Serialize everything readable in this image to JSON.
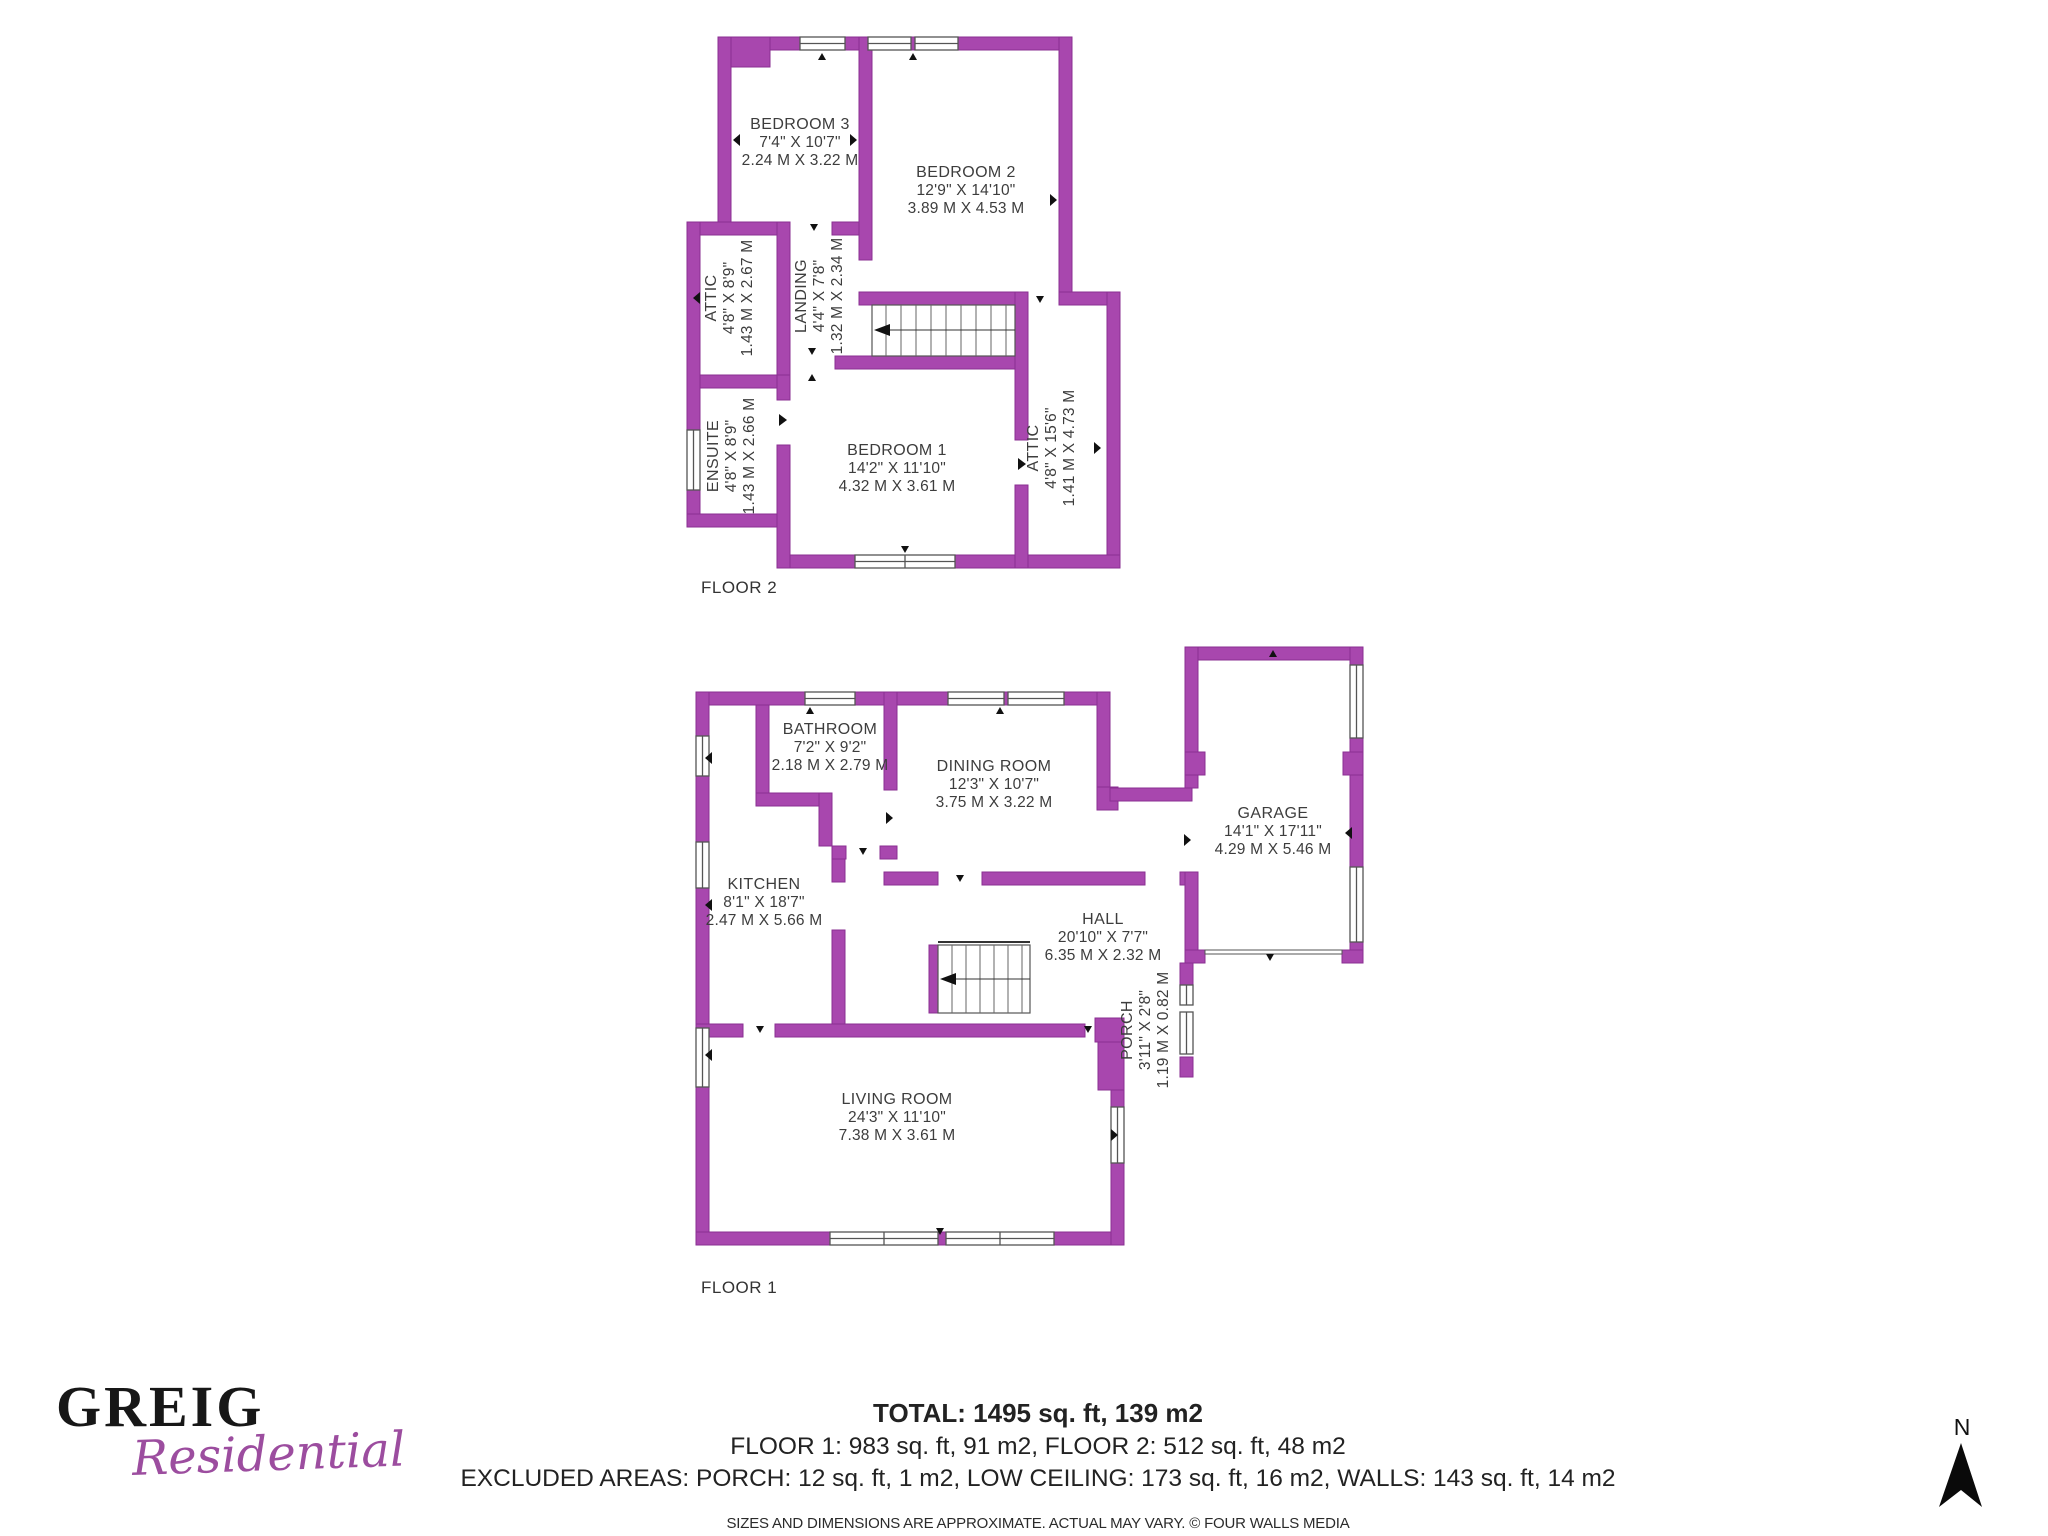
{
  "colors": {
    "wall": "#A847AE",
    "wall_edge": "#8A2F92",
    "logo_purple": "#9C4D9F",
    "text": "#3D3D3D"
  },
  "floors": [
    {
      "label": "FLOOR 2",
      "rooms": [
        {
          "name": "BEDROOM 3",
          "imperial": "7'4\" X 10'7\"",
          "metric": "2.24 M X 3.22 M"
        },
        {
          "name": "BEDROOM 2",
          "imperial": "12'9\" X 14'10\"",
          "metric": "3.89 M X 4.53 M"
        },
        {
          "name": "ATTIC",
          "imperial": "4'8\" X 8'9\"",
          "metric": "1.43 M X 2.67 M"
        },
        {
          "name": "LANDING",
          "imperial": "4'4\" X 7'8\"",
          "metric": "1.32 M X 2.34 M"
        },
        {
          "name": "ENSUITE",
          "imperial": "4'8\" X 8'9\"",
          "metric": "1.43 M X 2.66 M"
        },
        {
          "name": "BEDROOM 1",
          "imperial": "14'2\" X 11'10\"",
          "metric": "4.32 M X 3.61 M"
        },
        {
          "name": "ATTIC",
          "imperial": "4'8\" X 15'6\"",
          "metric": "1.41 M X 4.73 M"
        }
      ]
    },
    {
      "label": "FLOOR 1",
      "rooms": [
        {
          "name": "BATHROOM",
          "imperial": "7'2\" X 9'2\"",
          "metric": "2.18 M X 2.79 M"
        },
        {
          "name": "DINING ROOM",
          "imperial": "12'3\" X 10'7\"",
          "metric": "3.75 M X 3.22 M"
        },
        {
          "name": "KITCHEN",
          "imperial": "8'1\" X 18'7\"",
          "metric": "2.47 M X 5.66 M"
        },
        {
          "name": "HALL",
          "imperial": "20'10\" X 7'7\"",
          "metric": "6.35 M X 2.32 M"
        },
        {
          "name": "GARAGE",
          "imperial": "14'1\" X 17'11\"",
          "metric": "4.29 M X 5.46 M"
        },
        {
          "name": "PORCH",
          "imperial": "3'11\" X 2'8\"",
          "metric": "1.19 M X 0.82 M"
        },
        {
          "name": "LIVING ROOM",
          "imperial": "24'3\" X 11'10\"",
          "metric": "7.38 M X 3.61 M"
        }
      ]
    }
  ],
  "footer": {
    "total": "TOTAL: 1495 sq. ft, 139 m2",
    "floors_line": "FLOOR 1: 983 sq. ft, 91 m2, FLOOR 2: 512 sq. ft, 48 m2",
    "excluded_line": "EXCLUDED AREAS: PORCH: 12 sq. ft, 1 m2, LOW CEILING: 173 sq. ft, 16 m2, WALLS: 143 sq. ft, 14 m2",
    "disclaimer": "SIZES AND DIMENSIONS ARE APPROXIMATE. ACTUAL MAY VARY. © FOUR WALLS MEDIA"
  },
  "logo": {
    "name": "GREIG",
    "tagline": "Residential"
  },
  "compass": {
    "label": "N"
  }
}
